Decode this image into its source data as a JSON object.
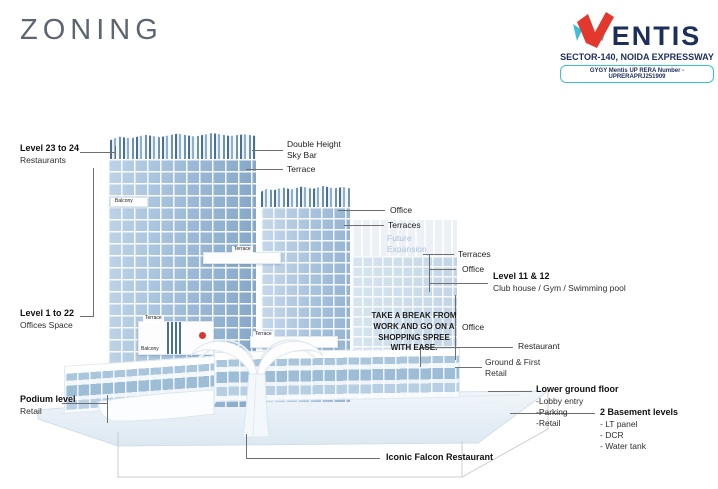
{
  "title": "ZONING",
  "logo": {
    "brand": "VENTIS",
    "brand_rest": "ENTIS",
    "tagline": "SECTOR-140, NOIDA EXPRESSWAY",
    "rera_badge": "GYGY Mentis UP RERA Number - UPRERAPRJ251909",
    "colors": {
      "red": "#e2382e",
      "cyan": "#3bc0dc",
      "navy": "#1c2e5c"
    }
  },
  "labels": {
    "level_23_24": {
      "title": "Level 23 to 24",
      "sub": "Restaurants"
    },
    "level_1_22": {
      "title": "Level 1 to 22",
      "sub": "Offices Space"
    },
    "podium": {
      "title": "Podium level",
      "sub": "Retail"
    },
    "sky_bar": "Double Height Sky Bar",
    "terrace_top": "Terrace",
    "office_top": "Office",
    "terraces_top": "Terraces",
    "future_expansion": "Future Expansion",
    "terraces_right": "Terraces",
    "office_right": "Office",
    "level_11_12": {
      "title": "Level 11 & 12",
      "sub": "Club house / Gym / Swimming pool"
    },
    "shopping_note": "TAKE A BREAK FROM WORK AND GO ON A SHOPPING SPREE WITH EASE.",
    "office_mid": "Office",
    "restaurant": "Restaurant",
    "ground_first": {
      "title": "Ground & First",
      "sub": "Retail"
    },
    "lower_ground": {
      "title": "Lower ground floor",
      "items": [
        "-Lobby entry",
        "-Parking",
        "-Retail"
      ]
    },
    "basement": {
      "title": "2 Basement levels",
      "items": [
        "- LT panel",
        "- DCR",
        "- Water tank"
      ]
    },
    "falcon": "Iconic Falcon Restaurant",
    "building_tags": {
      "terrace": "Terrace",
      "balcony": "Balcony"
    }
  },
  "palette": {
    "glass": "#a3c0db",
    "glass_light": "#c8d9e9",
    "ghost": "#e9eef5",
    "future_text": "#a9c4dd"
  }
}
